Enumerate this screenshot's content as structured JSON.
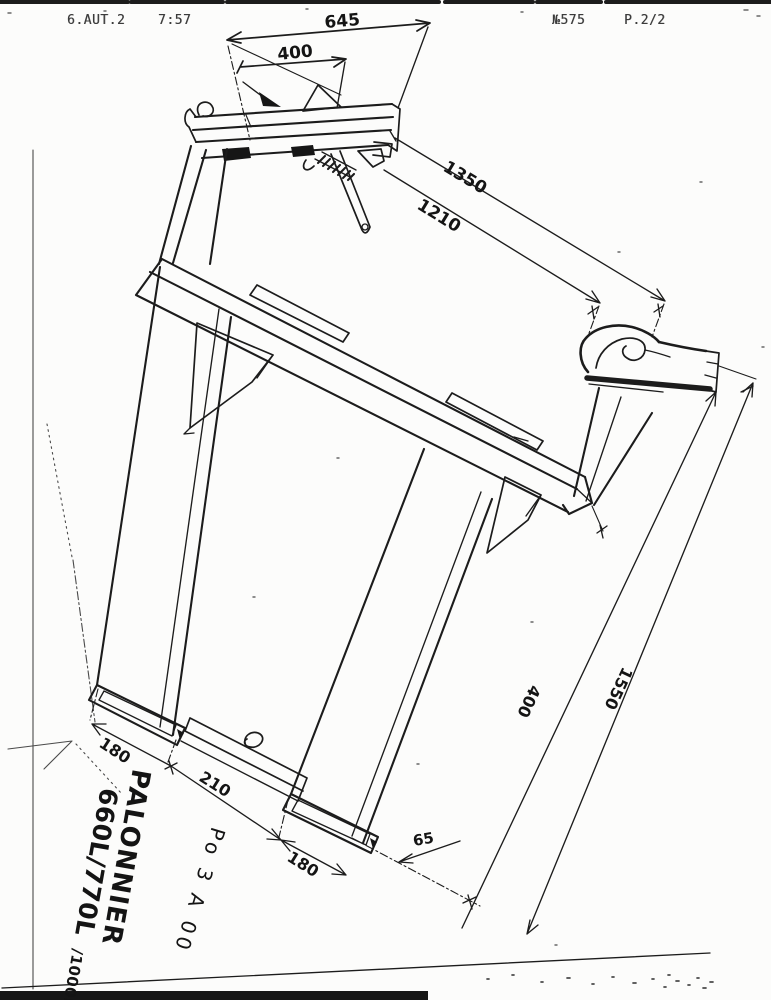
{
  "fax_header": {
    "station": "6.AUT.2",
    "time": "7:57",
    "doc_number": "№575",
    "page": "P.2/2"
  },
  "dimensions": {
    "top_width_overall": "645",
    "top_width_inner": "400",
    "beam_length_outer": "1350",
    "beam_length_inner": "1210",
    "fork_left_width": "180",
    "fork_spacing": "210",
    "fork_right_width": "180",
    "fork_tip_height": "65",
    "hook_drop": "400",
    "overall_height": "1550"
  },
  "title_block": {
    "name": "PALONNIER",
    "models": "660L/770L",
    "models_extra": "/1000L",
    "reference": "Po 3 A 00"
  }
}
